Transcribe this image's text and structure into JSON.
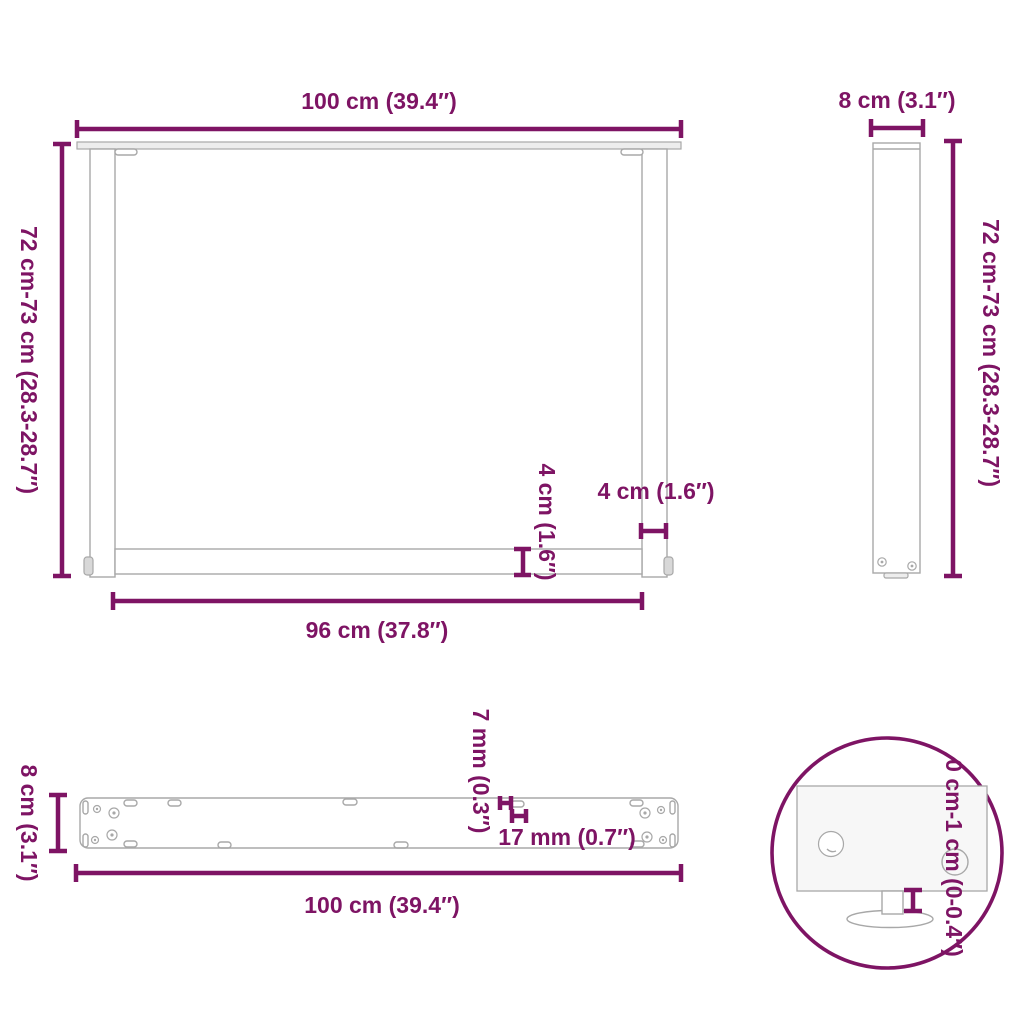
{
  "title": "Table leg dimensions diagram",
  "colors": {
    "accent": "#7E1464",
    "line_gray": "#A8A8A8",
    "fill_light": "#EDEDED",
    "fill_mid": "#D8D8D8",
    "fill_panel": "#F7F7F7",
    "background": "#FFFFFF"
  },
  "views": {
    "front": {
      "name": "front view of U-shaped table leg",
      "labels": {
        "width_top": "100 cm (39.4″)",
        "height_left": "72 cm-73 cm (28.3-28.7″)",
        "inner_width": "96 cm (37.8″)",
        "leg_width": "4 cm (1.6″)",
        "bar_height": "4 cm (1.6″)"
      }
    },
    "side": {
      "name": "side view of table leg",
      "labels": {
        "depth_top": "8 cm (3.1″)",
        "height_right": "72 cm-73 cm (28.3-28.7″)"
      }
    },
    "top": {
      "name": "top view of mounting bar",
      "labels": {
        "depth_left": "8 cm (3.1″)",
        "width_bottom": "100 cm (39.4″)",
        "slot_width": "7 mm (0.3″)",
        "hole_pitch": "17 mm (0.7″)"
      }
    },
    "detail": {
      "name": "detail of adjustable foot",
      "labels": {
        "adjustable_height": "0 cm-1 cm (0-0.4″)"
      }
    }
  }
}
